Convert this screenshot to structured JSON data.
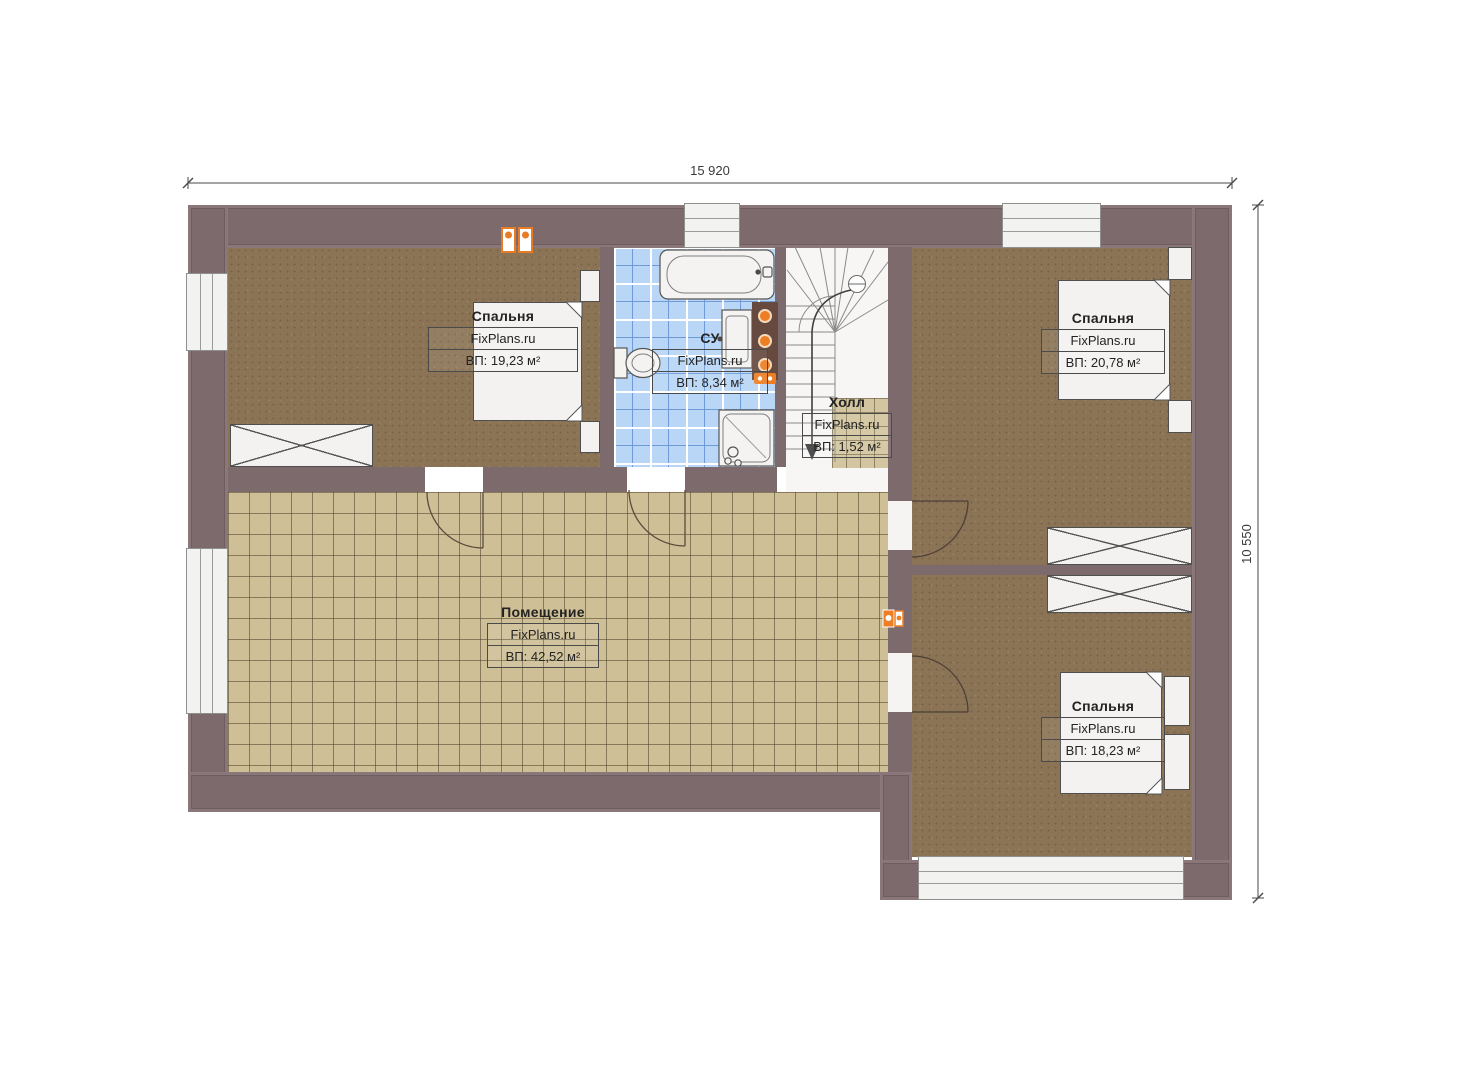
{
  "document": {
    "type": "floor-plan",
    "language": "ru",
    "brand_watermark": "FixPlans.ru"
  },
  "dimensions": {
    "width_label": "15 920",
    "height_label": "10 550"
  },
  "rooms": [
    {
      "id": "bedroom-top-left",
      "name": "Спальня",
      "watermark": "FixPlans.ru",
      "area_label": "ВП: 19,23 м²"
    },
    {
      "id": "bathroom",
      "name": "СУ",
      "watermark": "FixPlans.ru",
      "area_label": "ВП: 8,34 м²"
    },
    {
      "id": "hall",
      "name": "Холл",
      "watermark": "FixPlans.ru",
      "area_label": "ВП: 1,52 м²"
    },
    {
      "id": "bedroom-top-right",
      "name": "Спальня",
      "watermark": "FixPlans.ru",
      "area_label": "ВП: 20,78 м²"
    },
    {
      "id": "bedroom-bottom-right",
      "name": "Спальня",
      "watermark": "FixPlans.ru",
      "area_label": "ВП: 18,23 м²"
    },
    {
      "id": "main-room",
      "name": "Помещение",
      "watermark": "FixPlans.ru",
      "area_label": "ВП: 42,52 м²"
    }
  ],
  "colors": {
    "wall": "#7d6a6d",
    "floor_wood_brown": "#8b7355",
    "floor_tile_tan": "#cfbf96",
    "floor_tile_bath_blue": "#b9d6f6",
    "window_white": "#f2f2f1",
    "accent_orange": "#ed7d23",
    "linework_dark": "#4a4a4a"
  }
}
